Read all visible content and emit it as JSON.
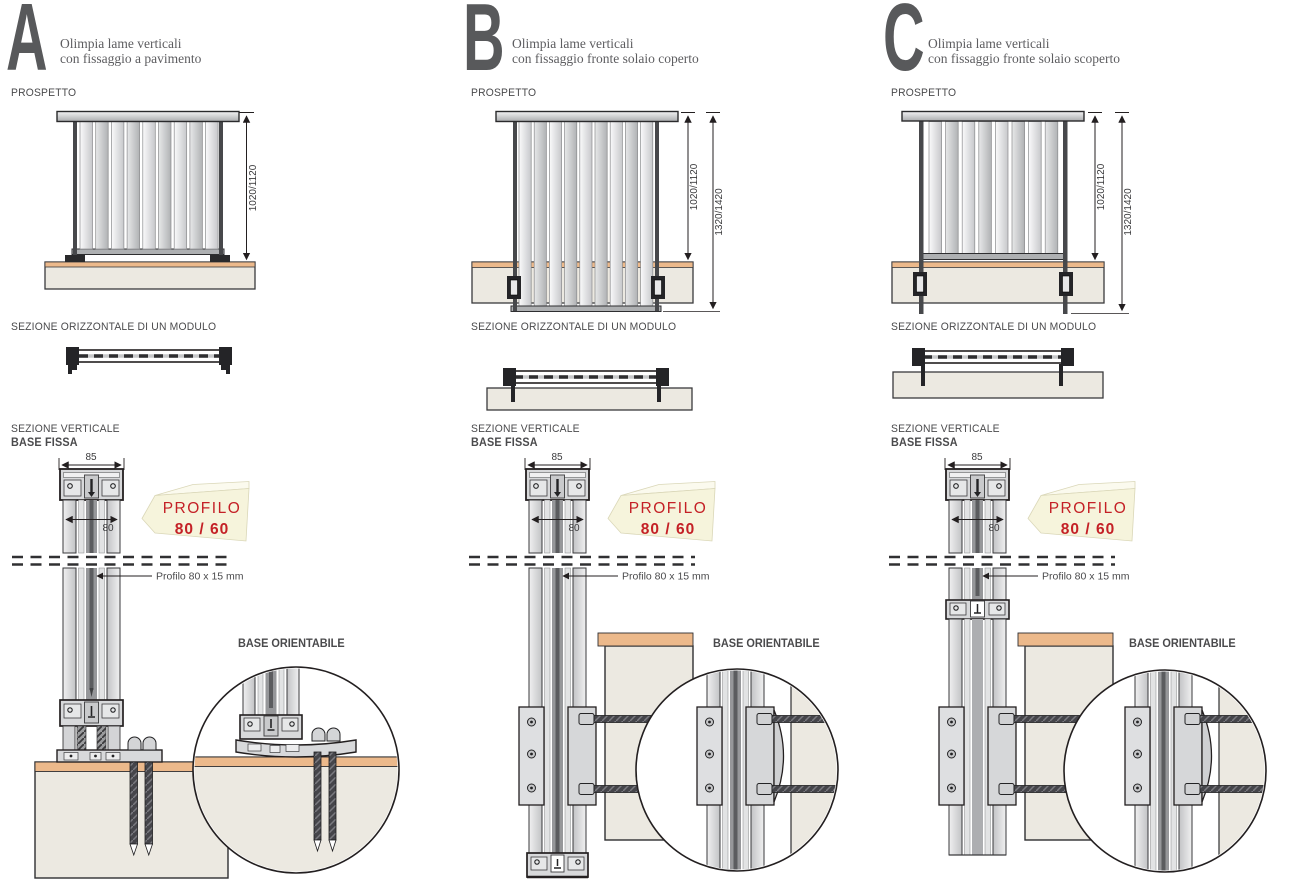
{
  "colors": {
    "accent_red": "#C42026",
    "callout_bg": "#F6F4DC",
    "letter_gray": "#58595B",
    "slab": "#ECE9E1",
    "slab_top": "#ECB98B"
  },
  "sections": [
    {
      "id": "A",
      "letter": "A",
      "description": [
        "Olimpia lame verticali",
        "con fissaggio a pavimento"
      ],
      "labels": {
        "elevation": "PROSPETTO",
        "horizontal_section": "SEZIONE ORIZZONTALE DI UN MODULO",
        "vertical_section": "SEZIONE VERTICALE",
        "fixed_base": "BASE FISSA",
        "orientable_base": "BASE ORIENTABILE"
      },
      "dimensions": {
        "height": "1020/1120",
        "top_width": "85",
        "profile_width": "80",
        "profile_note": "Profilo 80 x 15 mm"
      },
      "callout": {
        "title": "PROFILO",
        "size": "80 / 60"
      }
    },
    {
      "id": "B",
      "letter": "B",
      "description": [
        "Olimpia lame verticali",
        "con fissaggio fronte solaio coperto"
      ],
      "labels": {
        "elevation": "PROSPETTO",
        "horizontal_section": "SEZIONE ORIZZONTALE DI UN MODULO",
        "vertical_section": "SEZIONE VERTICALE",
        "fixed_base": "BASE FISSA",
        "orientable_base": "BASE ORIENTABILE"
      },
      "dimensions": {
        "height": "1020/1120",
        "total_height": "1320/1420",
        "top_width": "85",
        "profile_width": "80",
        "profile_note": "Profilo 80 x 15 mm"
      },
      "callout": {
        "title": "PROFILO",
        "size": "80 / 60"
      }
    },
    {
      "id": "C",
      "letter": "C",
      "description": [
        "Olimpia lame verticali",
        "con fissaggio fronte solaio scoperto"
      ],
      "labels": {
        "elevation": "PROSPETTO",
        "horizontal_section": "SEZIONE ORIZZONTALE DI UN MODULO",
        "vertical_section": "SEZIONE VERTICALE",
        "fixed_base": "BASE FISSA",
        "orientable_base": "BASE ORIENTABILE"
      },
      "dimensions": {
        "height": "1020/1120",
        "total_height": "1320/1420",
        "top_width": "85",
        "profile_width": "80",
        "profile_note": "Profilo 80 x 15 mm"
      },
      "callout": {
        "title": "PROFILO",
        "size": "80 / 60"
      }
    }
  ]
}
